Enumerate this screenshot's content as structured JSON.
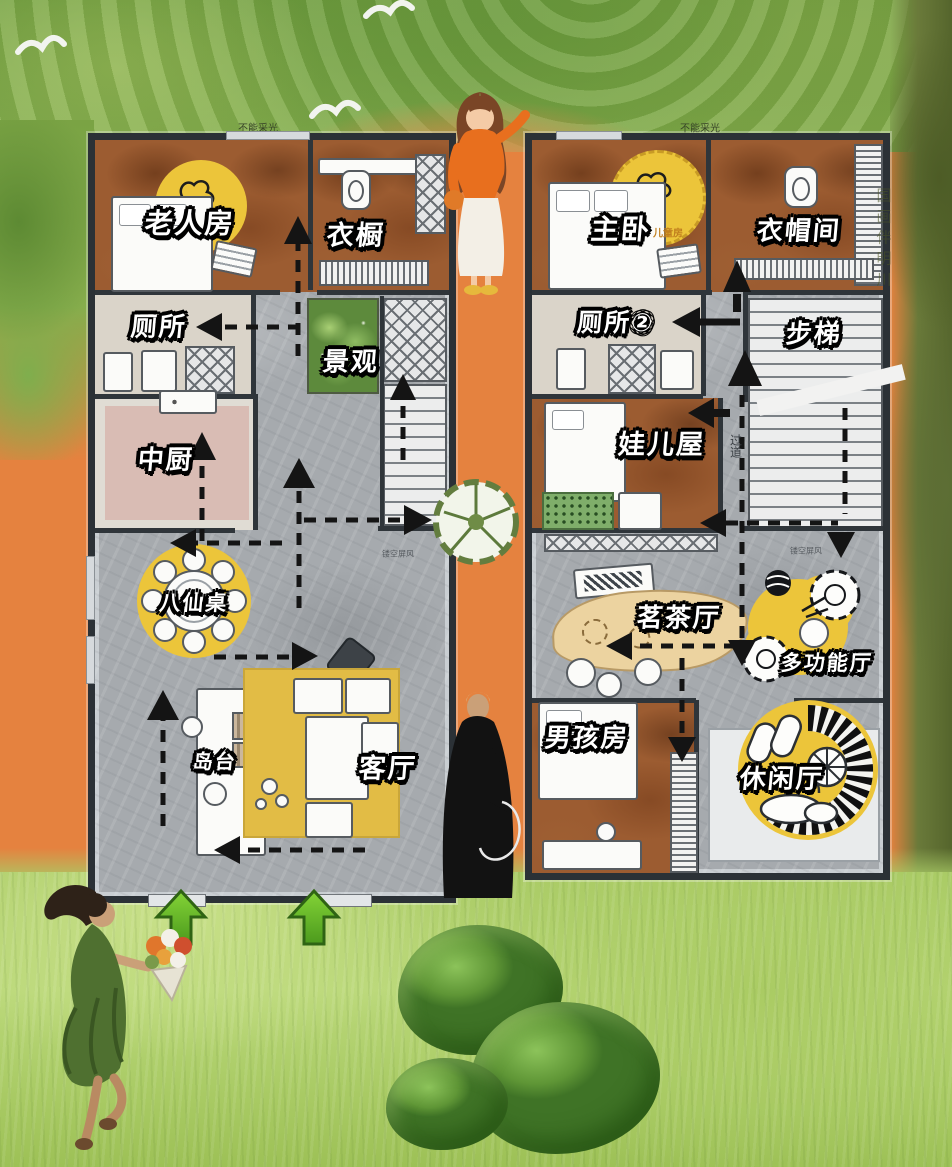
{
  "poster": {
    "notes": {
      "left_no_light": "不能采光",
      "right_no_light": "不能采光",
      "watermark": "国画伴明川"
    },
    "floor1": {
      "rooms": [
        {
          "id": "elder-room",
          "label": "老人房"
        },
        {
          "id": "wardrobe",
          "label": "衣橱"
        },
        {
          "id": "toilet",
          "label": "厕所"
        },
        {
          "id": "landscape",
          "label": "景观"
        },
        {
          "id": "chinese-kitchen",
          "label": "中厨"
        },
        {
          "id": "eight-immortals-table",
          "label": "八仙桌"
        },
        {
          "id": "island-counter",
          "label": "岛台"
        },
        {
          "id": "living-room",
          "label": "客厅"
        }
      ],
      "small_notes": [
        {
          "id": "hollow-screen",
          "label": "镂空屏风"
        }
      ]
    },
    "floor2": {
      "rooms": [
        {
          "id": "master-bedroom",
          "label": "主卧"
        },
        {
          "id": "cloakroom",
          "label": "衣帽间"
        },
        {
          "id": "toilet-2",
          "label": "厕所②"
        },
        {
          "id": "stairs",
          "label": "步梯"
        },
        {
          "id": "kids-room",
          "label": "娃儿屋"
        },
        {
          "id": "tea-room",
          "label": "茗茶厅"
        },
        {
          "id": "multi-function-hall",
          "label": "多功能厅"
        },
        {
          "id": "boys-room",
          "label": "男孩房"
        },
        {
          "id": "leisure-hall",
          "label": "休闲厅"
        }
      ],
      "small_notes": [
        {
          "id": "kids-room-note",
          "label": "儿童房"
        },
        {
          "id": "corridor",
          "label": "过道"
        },
        {
          "id": "hollow-screen",
          "label": "镂空屏风"
        }
      ]
    },
    "colors": {
      "path_orange": "#e5823f",
      "foliage_green": "#7fa23f",
      "grass_green": "#b5d371",
      "accent_yellow": "#ecc53a",
      "wall_dark": "#2f353a",
      "floor_gray": "#a6aaae",
      "floor_brown": "#9c5c31",
      "floor_pink": "#d9bcb4",
      "arrow_black": "#141414",
      "entry_arrow_green": "#6cbc2e"
    }
  }
}
